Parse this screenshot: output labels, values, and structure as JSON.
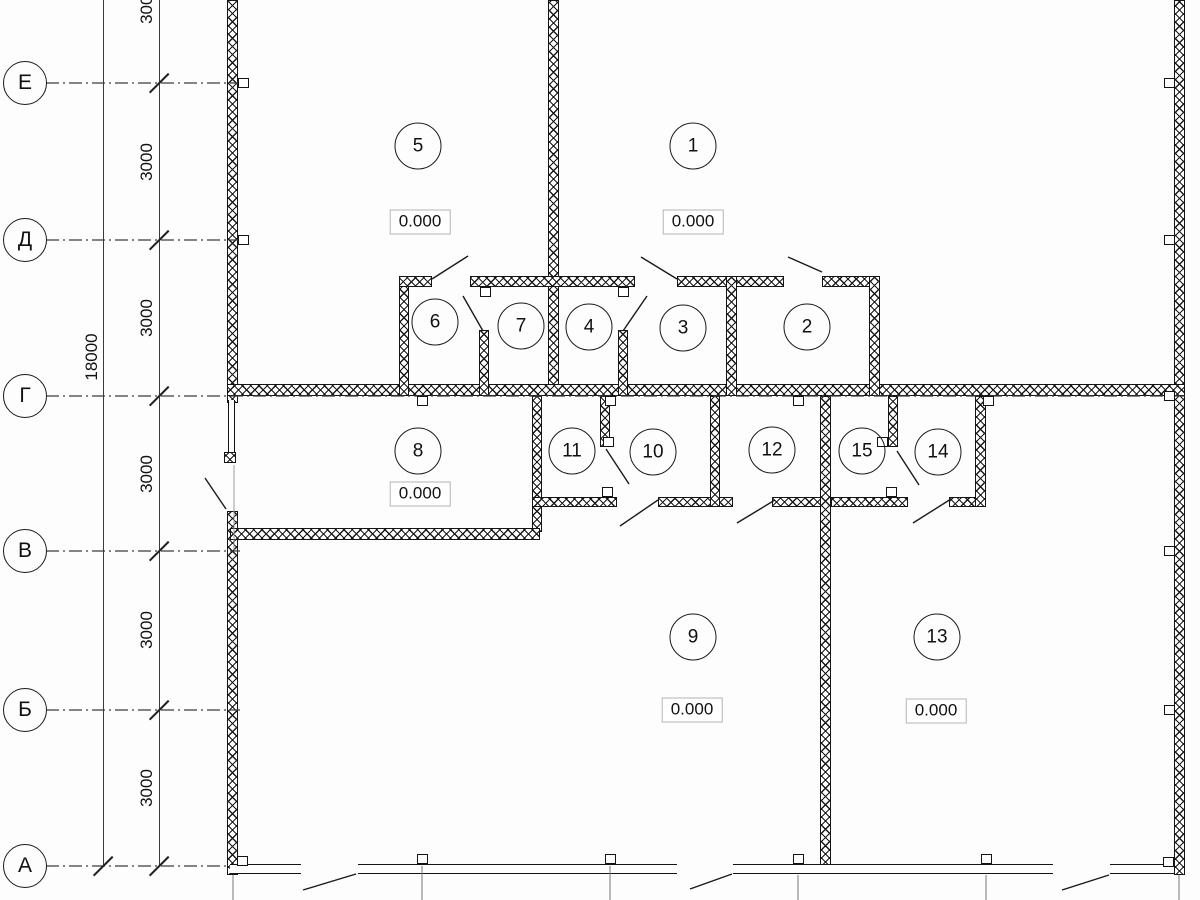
{
  "drawing": {
    "type": "architectural-floor-plan",
    "line_color": "#1a1a1a",
    "background": "#fdfdfd"
  },
  "axes": {
    "items": [
      {
        "label": "Е"
      },
      {
        "label": "Д"
      },
      {
        "label": "Г"
      },
      {
        "label": "В"
      },
      {
        "label": "Б"
      },
      {
        "label": "А"
      }
    ]
  },
  "dimensions": {
    "total": "18000",
    "segments": [
      {
        "value": "3000"
      },
      {
        "value": "3000"
      },
      {
        "value": "3000"
      },
      {
        "value": "3000"
      },
      {
        "value": "3000"
      },
      {
        "value": "3000"
      }
    ]
  },
  "rooms": [
    "1",
    "2",
    "3",
    "4",
    "5",
    "6",
    "7",
    "8",
    "9",
    "10",
    "11",
    "12",
    "13",
    "14",
    "15"
  ],
  "elevations": [
    {
      "value": "0.000"
    },
    {
      "value": "0.000"
    },
    {
      "value": "0.000"
    },
    {
      "value": "0.000"
    },
    {
      "value": "0.000"
    }
  ]
}
